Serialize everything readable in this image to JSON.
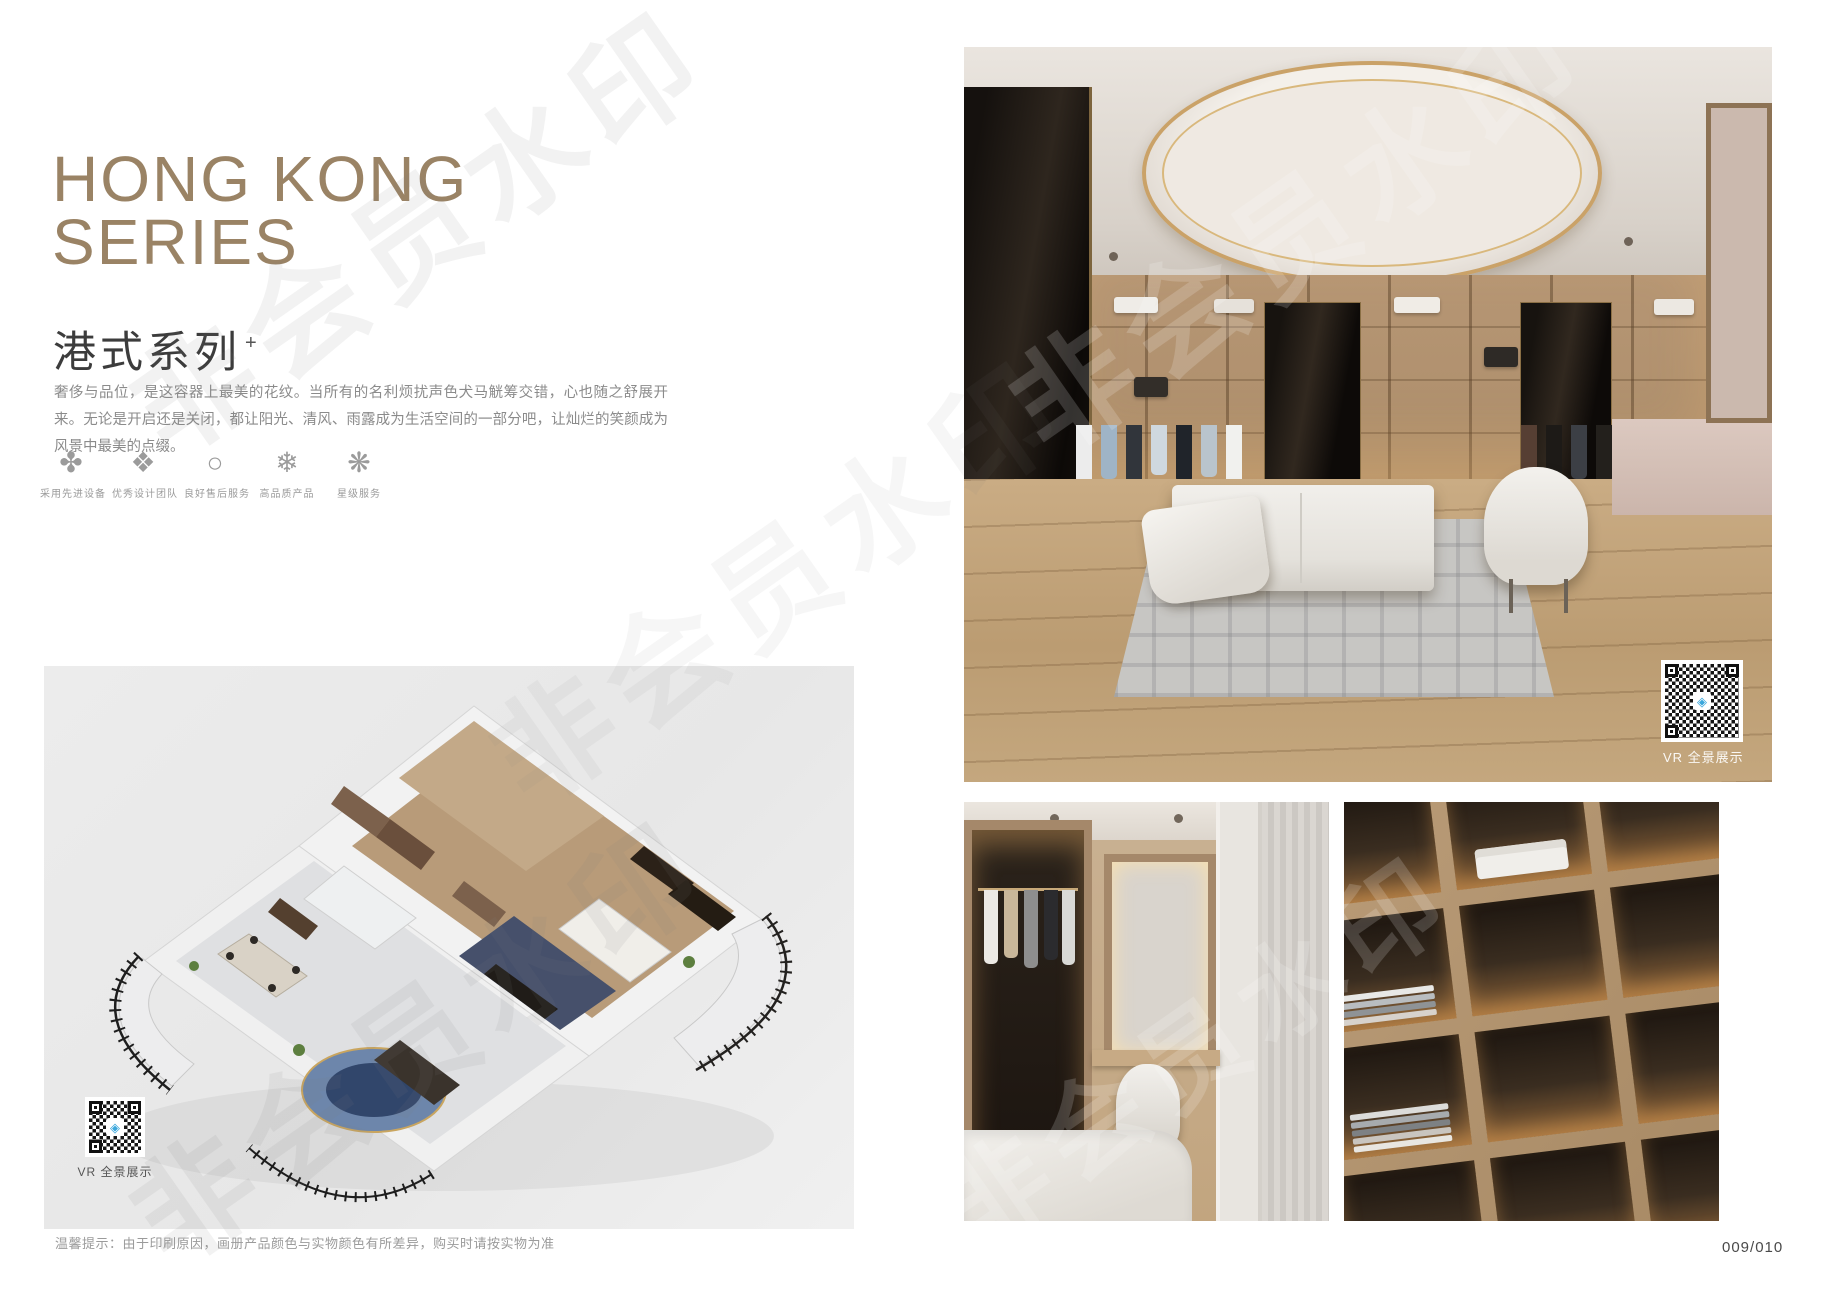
{
  "header": {
    "title_line1": "HONG KONG",
    "title_line2": "SERIES",
    "subtitle": "港式系列",
    "subtitle_superscript": "+",
    "description": "奢侈与品位，是这容器上最美的花纹。当所有的名利烦扰声色犬马觥筹交错，心也随之舒展开来。无论是开启还是关闭，都让阳光、清风、雨露成为生活空间的一部分吧，让灿烂的笑颜成为风景中最美的点缀。"
  },
  "features": [
    {
      "icon": "pinwheel-icon",
      "glyph": "✤",
      "label": "采用先进设备"
    },
    {
      "icon": "diamond-ornament-icon",
      "glyph": "❖",
      "label": "优秀设计团队"
    },
    {
      "icon": "ring-icon",
      "glyph": "○",
      "label": "良好售后服务"
    },
    {
      "icon": "snowflake-icon",
      "glyph": "❄",
      "label": "高品质产品"
    },
    {
      "icon": "star-ornament-icon",
      "glyph": "❋",
      "label": "星级服务"
    }
  ],
  "floorplan": {
    "vr_badge_label": "VR 全景展示"
  },
  "gallery": {
    "vr_badge_label": "VR 全景展示"
  },
  "footer": {
    "note": "温馨提示：由于印刷原因，画册产品颜色与实物颜色有所差异，购买时请按实物为准",
    "page_number": "009/010"
  },
  "watermark": {
    "text": "非会员水印"
  },
  "colors": {
    "accent_tan": "#9a8365",
    "subtitle_dark": "#3c3c3c",
    "body_gray": "#8b8b8b",
    "panel_gray": "#e9e9e9",
    "gold_trim": "#caa268",
    "qr_logo_blue": "#3aa7dc"
  }
}
